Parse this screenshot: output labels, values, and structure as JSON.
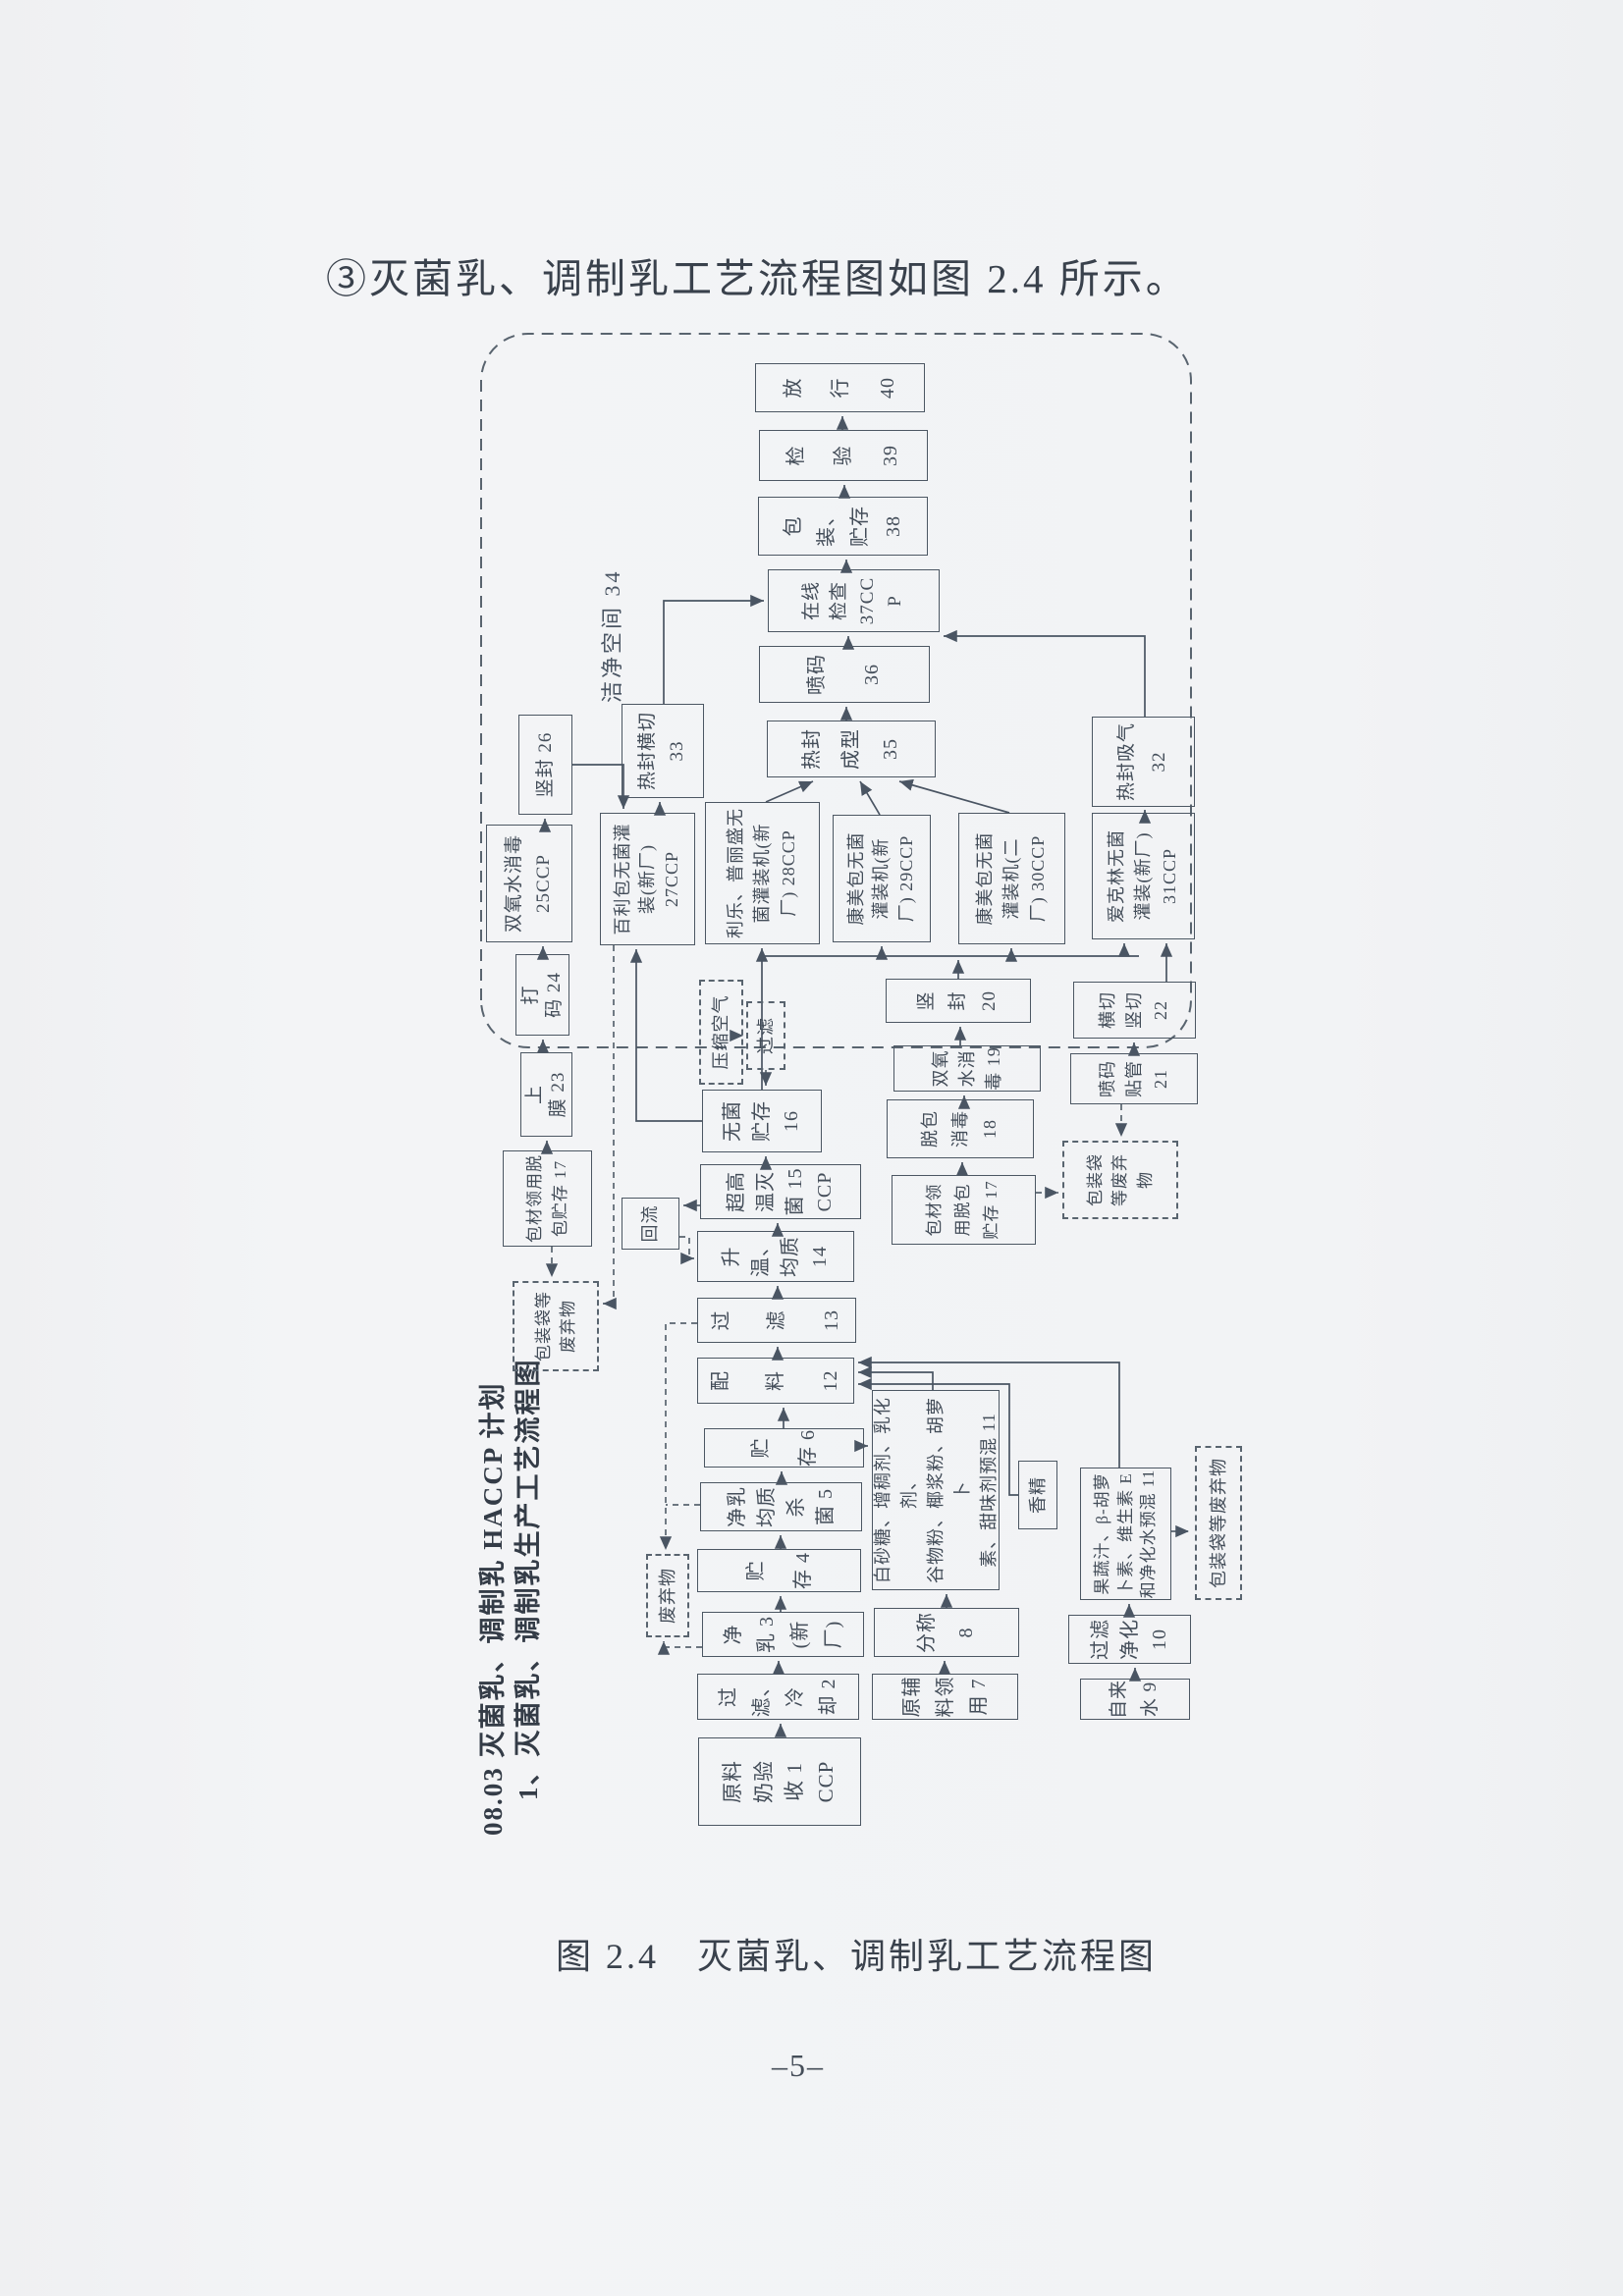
{
  "page": {
    "heading": "③灭菌乳、调制乳工艺流程图如图 2.4 所示。",
    "caption": "图 2.4　灭菌乳、调制乳工艺流程图",
    "page_number": "–5–"
  },
  "chart": {
    "title_line1": "08.03 灭菌乳、调制乳 HACCP 计划",
    "title_line2": "1、灭菌乳、调制乳生产工艺流程图",
    "clean_zone_label": "洁净空间 34",
    "colors": {
      "ink": "#4a5563",
      "paper": "#f2f3f5"
    },
    "boxes": {
      "b01": "原料\n奶验\n收 1\nCCP",
      "b02": "过\n滤、\n冷\n却 2",
      "b03": "净\n乳 3\n(新\n厂)",
      "b04": "贮\n存 4",
      "b05": "净乳\n均质\n杀\n菌 5",
      "b06": "贮\n存 6",
      "b07": "原辅\n料领\n用 7",
      "b08": "分称\n8",
      "b09": "自来\n水 9",
      "b10": "过滤\n净化\n10",
      "b11": "白砂糖、增稠剂、乳化剂、\n谷物粉、椰浆粉、胡萝卜\n素、甜味剂预混 11",
      "b11b": "果蔬汁、β-胡萝\n卜素、维生素 E\n和净化水预混 11",
      "flavor": "香精",
      "b12": "配\n料 12",
      "b13": "过\n滤 13",
      "b14": "升\n温、\n均质\n14",
      "b15": "超高\n温灭\n菌 15\nCCP",
      "b16": "无菌\n贮存\n16",
      "b17l": "包材领用脱\n包贮存 17",
      "b17r": "包材领\n用脱包\n贮存 17",
      "b18": "脱包\n消毒\n18",
      "b19": "双氧\n水消\n毒 19",
      "b20": "竖\n封\n20",
      "b21": "喷码\n贴管\n21",
      "b22": "横切\n竖切\n22",
      "b23": "上\n膜 23",
      "b24": "打\n码 24",
      "b25": "双氧水消毒\n25CCP",
      "b26": "竖封 26",
      "b27": "百利包无菌灌\n装(新厂)\n27CCP",
      "b28": "利乐、普丽盛无\n菌灌装机(新\n厂) 28CCP",
      "b29": "康美包无菌\n灌装机(新\n厂) 29CCP",
      "b30": "康美包无菌\n灌装机(二\n厂) 30CCP",
      "b31": "爱克林无菌\n灌装(新厂)\n31CCP",
      "b32": "热封吸气\n32",
      "b33": "热封横切\n33",
      "b35": "热封\n成型\n35",
      "b36": "喷码\n36",
      "b37": "在线\n检查\n37CC\nP",
      "b38": "包装、\n贮存\n38",
      "b39": "检\n验\n39",
      "b40": "放\n行\n40",
      "reflux": "回流",
      "compressed_air": "压缩空气",
      "air_filter": "过滤",
      "waste": "废弃物",
      "waste_pkg_left": "包装袋等\n废弃物",
      "waste_pkg_right": "包装袋\n等废弃\n物",
      "waste_pkg_bottom": "包装袋等废弃物"
    }
  }
}
